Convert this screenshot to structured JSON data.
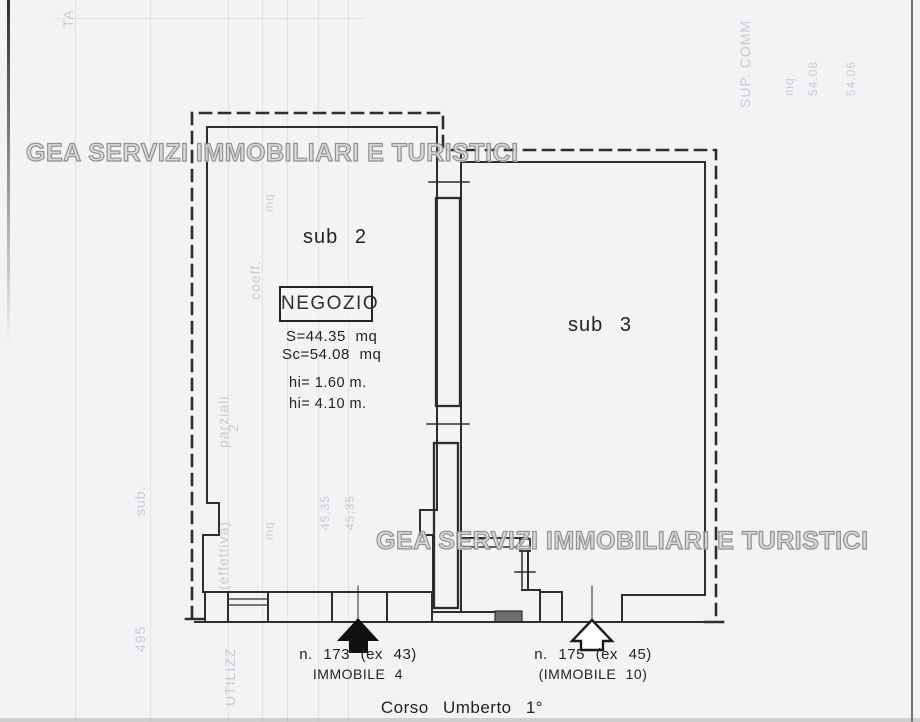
{
  "watermarks": {
    "top": "GEA SERVIZI IMMOBILIARI E TURISTICI",
    "middle": "GEA SERVIZI IMMOBILIARI E TURISTICI"
  },
  "plan": {
    "sub2_label": "sub 2",
    "sub3_label": "sub 3",
    "negozio": {
      "title": "NEGOZIO",
      "surface": "S=44.35 mq",
      "covered_surface": "Sc=54.08 mq",
      "height_1": "hi= 1.60 m.",
      "height_2": "hi= 4.10 m."
    },
    "entrance_left": {
      "number": "n. 173 (ex 43)",
      "name": "IMMOBILE 4"
    },
    "entrance_right": {
      "number": "n. 175 (ex 45)",
      "name": "(IMMOBILE 10)"
    },
    "street": "Corso Umberto 1°"
  },
  "bleedthrough": [
    {
      "text": "TA"
    },
    {
      "text": "SUP. COMM"
    },
    {
      "text": "mq"
    },
    {
      "text": "54.08"
    },
    {
      "text": "54.06"
    },
    {
      "text": "coeff."
    },
    {
      "text": "parziali"
    },
    {
      "text": "(effettiva)"
    },
    {
      "text": "mq"
    },
    {
      "text": "mq"
    },
    {
      "text": "2"
    },
    {
      "text": "sub."
    },
    {
      "text": "495"
    },
    {
      "text": "45,35"
    },
    {
      "text": "45,35"
    },
    {
      "text": "UTILIZZ"
    }
  ],
  "colors": {
    "paper": "#f3f3f5",
    "ink": "#2e2e2e",
    "watermark_gray": "#b5b5b5"
  }
}
